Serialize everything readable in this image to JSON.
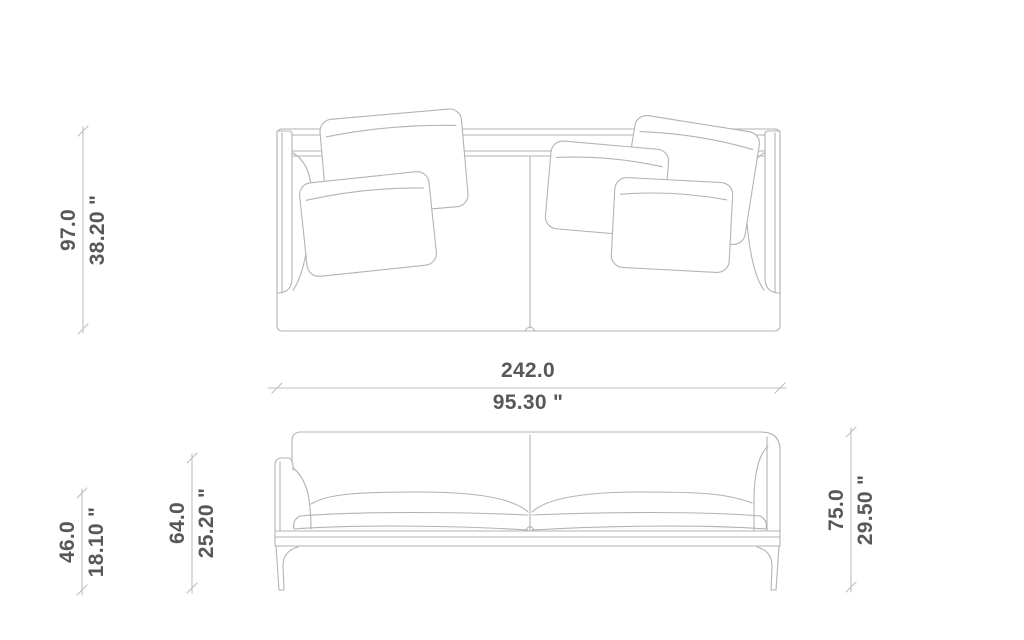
{
  "page": {
    "background": "#ffffff",
    "drawing_line_color": "#b3b3b3",
    "dimension_line_color": "#bfbfbf",
    "label_text_color": "#58585a"
  },
  "dimensions": {
    "depth": {
      "cm": "97.0",
      "inches": "38.20 \""
    },
    "width": {
      "cm": "242.0",
      "inches": "95.30 \""
    },
    "seat_height": {
      "cm": "46.0",
      "inches": "18.10 \""
    },
    "arm_height": {
      "cm": "64.0",
      "inches": "25.20 \""
    },
    "overall_height": {
      "cm": "75.0",
      "inches": "29.50 \""
    }
  }
}
